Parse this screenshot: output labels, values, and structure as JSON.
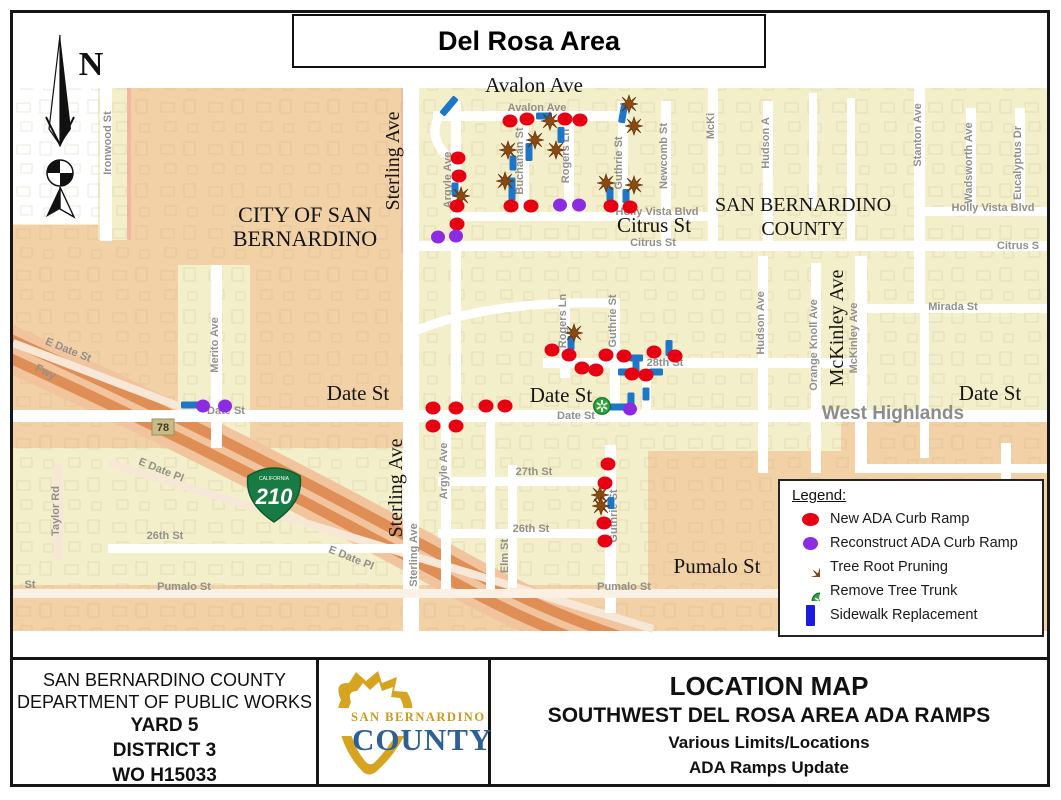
{
  "title": "Del Rosa Area",
  "compass": {
    "label": "N"
  },
  "map": {
    "area_labels": [
      {
        "t": "Avalon Ave",
        "x": 521,
        "y": 79,
        "s": 21
      },
      {
        "t": "CITY OF SAN",
        "x": 292,
        "y": 209,
        "s": 22
      },
      {
        "t": "BERNARDINO",
        "x": 292,
        "y": 233,
        "s": 22
      },
      {
        "t": "SAN BERNARDINO",
        "x": 790,
        "y": 198,
        "s": 20
      },
      {
        "t": "COUNTY",
        "x": 790,
        "y": 222,
        "s": 20
      },
      {
        "t": "Citrus St",
        "x": 641,
        "y": 219,
        "s": 21
      },
      {
        "t": "Date St",
        "x": 345,
        "y": 387,
        "s": 21
      },
      {
        "t": "Date St",
        "x": 548,
        "y": 389,
        "s": 21
      },
      {
        "t": "Date St",
        "x": 977,
        "y": 387,
        "s": 21
      },
      {
        "t": "Pumalo St",
        "x": 704,
        "y": 560,
        "s": 21
      },
      {
        "t": "Sterling Ave",
        "x": 386,
        "y": 148,
        "s": 20,
        "r": -90
      },
      {
        "t": "Sterling Ave",
        "x": 389,
        "y": 475,
        "s": 20,
        "r": -90
      },
      {
        "t": "McKinley Ave",
        "x": 830,
        "y": 315,
        "s": 20,
        "r": -90
      },
      {
        "t": "West Highlands",
        "x": 880,
        "y": 406,
        "s": 19,
        "gray": 1
      }
    ],
    "street_labels": [
      {
        "t": "Ironwood St",
        "x": 98,
        "y": 130,
        "r": -90
      },
      {
        "t": "Avalon Ave",
        "x": 524,
        "y": 98
      },
      {
        "t": "Argyle Ave",
        "x": 438,
        "y": 167,
        "r": -90
      },
      {
        "t": "Buchanan St",
        "x": 510,
        "y": 148,
        "r": -90
      },
      {
        "t": "Rogers Ln",
        "x": 556,
        "y": 143,
        "r": -90
      },
      {
        "t": "Guthrie St",
        "x": 609,
        "y": 150,
        "r": -90
      },
      {
        "t": "Newcomb St",
        "x": 654,
        "y": 143,
        "r": -90
      },
      {
        "t": "McKi",
        "x": 701,
        "y": 113,
        "r": -90
      },
      {
        "t": "Hudson A",
        "x": 756,
        "y": 130,
        "r": -90
      },
      {
        "t": "Stanton Ave",
        "x": 908,
        "y": 122,
        "r": -90
      },
      {
        "t": "Wadsworth Ave",
        "x": 959,
        "y": 150,
        "r": -90
      },
      {
        "t": "Eucalyptus Dr",
        "x": 1008,
        "y": 150,
        "r": -90
      },
      {
        "t": "Holly Vista Blvd",
        "x": 644,
        "y": 202
      },
      {
        "t": "Holly Vista Blvd",
        "x": 980,
        "y": 198
      },
      {
        "t": "Citrus St",
        "x": 640,
        "y": 233
      },
      {
        "t": "Citrus S",
        "x": 1005,
        "y": 236
      },
      {
        "t": "Mirada St",
        "x": 940,
        "y": 297
      },
      {
        "t": "28th St",
        "x": 652,
        "y": 353
      },
      {
        "t": "Rogers Ln",
        "x": 553,
        "y": 308,
        "r": -90
      },
      {
        "t": "Guthrie St",
        "x": 603,
        "y": 308,
        "r": -90
      },
      {
        "t": "McKinley Ave",
        "x": 844,
        "y": 325,
        "r": -90
      },
      {
        "t": "Hudson Ave",
        "x": 751,
        "y": 310,
        "r": -90
      },
      {
        "t": "Orange Knoll Ave",
        "x": 804,
        "y": 332,
        "r": -90
      },
      {
        "t": "Merito Ave",
        "x": 205,
        "y": 332,
        "r": -90
      },
      {
        "t": "Date St",
        "x": 213,
        "y": 401
      },
      {
        "t": "Date St",
        "x": 563,
        "y": 406
      },
      {
        "t": "Sterling Ave",
        "x": 404,
        "y": 542,
        "r": -90
      },
      {
        "t": "Argyle Ave",
        "x": 434,
        "y": 458,
        "r": -90
      },
      {
        "t": "27th St",
        "x": 521,
        "y": 462
      },
      {
        "t": "26th St",
        "x": 518,
        "y": 519
      },
      {
        "t": "26th St",
        "x": 152,
        "y": 526
      },
      {
        "t": "Elm St",
        "x": 495,
        "y": 543,
        "r": -90
      },
      {
        "t": "Taylor Rd",
        "x": 46,
        "y": 498,
        "r": -90
      },
      {
        "t": "Guthrie St",
        "x": 604,
        "y": 503,
        "r": -90
      },
      {
        "t": "E Date St",
        "x": 54,
        "y": 340,
        "r": 22
      },
      {
        "t": "E Date Pl",
        "x": 147,
        "y": 460,
        "r": 22
      },
      {
        "t": "E Date Pl",
        "x": 337,
        "y": 548,
        "r": 22
      },
      {
        "t": "Fwy",
        "x": 31,
        "y": 362,
        "r": 28
      },
      {
        "t": "Pumalo St",
        "x": 171,
        "y": 577
      },
      {
        "t": "Pumalo St",
        "x": 611,
        "y": 577
      },
      {
        "t": "St",
        "x": 17,
        "y": 575
      }
    ],
    "badges": [
      {
        "type": "square",
        "label": "78",
        "x": 150,
        "y": 414
      },
      {
        "type": "shield",
        "label": "210",
        "sub": "CALIFORNIA",
        "x": 261,
        "y": 481
      }
    ],
    "markers": {
      "red": [
        [
          497,
          108
        ],
        [
          514,
          106
        ],
        [
          552,
          106
        ],
        [
          567,
          107
        ],
        [
          445,
          145
        ],
        [
          446,
          163
        ],
        [
          444,
          193
        ],
        [
          444,
          211
        ],
        [
          498,
          193
        ],
        [
          518,
          193
        ],
        [
          598,
          193
        ],
        [
          617,
          194
        ],
        [
          539,
          337
        ],
        [
          556,
          342
        ],
        [
          593,
          342
        ],
        [
          611,
          343
        ],
        [
          641,
          339
        ],
        [
          662,
          343
        ],
        [
          569,
          355
        ],
        [
          583,
          357
        ],
        [
          619,
          361
        ],
        [
          633,
          362
        ],
        [
          420,
          395
        ],
        [
          443,
          395
        ],
        [
          473,
          393
        ],
        [
          492,
          393
        ],
        [
          420,
          413
        ],
        [
          443,
          413
        ],
        [
          595,
          451
        ],
        [
          592,
          470
        ],
        [
          591,
          510
        ],
        [
          592,
          528
        ]
      ],
      "purple": [
        [
          425,
          224
        ],
        [
          443,
          223
        ],
        [
          547,
          192
        ],
        [
          566,
          192
        ],
        [
          617,
          396
        ],
        [
          190,
          393
        ],
        [
          212,
          393
        ]
      ],
      "tree": [
        [
          537,
          108
        ],
        [
          616,
          91
        ],
        [
          621,
          113
        ],
        [
          522,
          127
        ],
        [
          495,
          137
        ],
        [
          543,
          137
        ],
        [
          448,
          183
        ],
        [
          492,
          168
        ],
        [
          593,
          170
        ],
        [
          621,
          172
        ],
        [
          561,
          320
        ],
        [
          587,
          482
        ],
        [
          588,
          493
        ]
      ],
      "green": [
        [
          589,
          393
        ]
      ],
      "blue": [
        [
          436,
          93,
          22,
          40
        ],
        [
          531,
          103,
          16,
          90
        ],
        [
          610,
          101,
          18,
          10
        ],
        [
          516,
          139,
          18,
          0
        ],
        [
          548,
          122,
          16,
          0
        ],
        [
          500,
          150,
          15,
          0
        ],
        [
          499,
          176,
          23,
          0
        ],
        [
          442,
          176,
          13,
          0
        ],
        [
          597,
          181,
          14,
          0
        ],
        [
          613,
          183,
          14,
          0
        ],
        [
          558,
          330,
          14,
          0
        ],
        [
          623,
          345,
          14,
          90
        ],
        [
          656,
          335,
          16,
          0
        ],
        [
          614,
          359,
          18,
          90
        ],
        [
          643,
          359,
          14,
          90
        ],
        [
          623,
          354,
          18,
          0
        ],
        [
          633,
          381,
          13,
          0
        ],
        [
          618,
          387,
          15,
          0
        ],
        [
          607,
          394,
          21,
          90
        ],
        [
          177,
          392,
          18,
          90
        ],
        [
          598,
          490,
          12,
          0
        ]
      ]
    },
    "legend": {
      "title": "Legend:",
      "items": [
        {
          "icon": "red-dot",
          "label": "New ADA Curb Ramp"
        },
        {
          "icon": "purple-dot",
          "label": "Reconstruct ADA Curb Ramp"
        },
        {
          "icon": "tree-root-icon",
          "label": "Tree Root Pruning"
        },
        {
          "icon": "tree-trunk-icon",
          "label": "Remove Tree Trunk"
        },
        {
          "icon": "blue-bar",
          "label": "Sidewalk Replacement"
        }
      ]
    }
  },
  "footer": {
    "agency_line1": "SAN BERNARDINO COUNTY",
    "agency_line2": "DEPARTMENT OF PUBLIC WORKS",
    "agency_line3": "YARD 5",
    "agency_line4": "DISTRICT 3",
    "agency_line5": "WO H15033",
    "logo_top": "SAN BERNARDINO",
    "logo_bottom": "COUNTY",
    "right_title": "LOCATION MAP",
    "right_line1": "SOUTHWEST DEL ROSA AREA ADA RAMPS",
    "right_line2": "Various Limits/Locations",
    "right_line3": "ADA Ramps Update"
  },
  "colors": {
    "cream": "#F4EFCB",
    "tan": "#F2D1A6",
    "road_tan": "#F7E7D7",
    "freeway_shoulder": "#F1C49E",
    "freeway_band": "#DF8E55",
    "red": "#E60012",
    "purple": "#8B2BE2",
    "blue_map": "#1E76C8",
    "blue_legend": "#1C1CDE",
    "tree_brown": "#8B4A12",
    "trunk_green": "#2EA23C",
    "badge_khaki": "#C9BB84",
    "shield_green": "#177B43",
    "logo_gold": "#D7A422",
    "logo_blue": "#2E5F95"
  }
}
